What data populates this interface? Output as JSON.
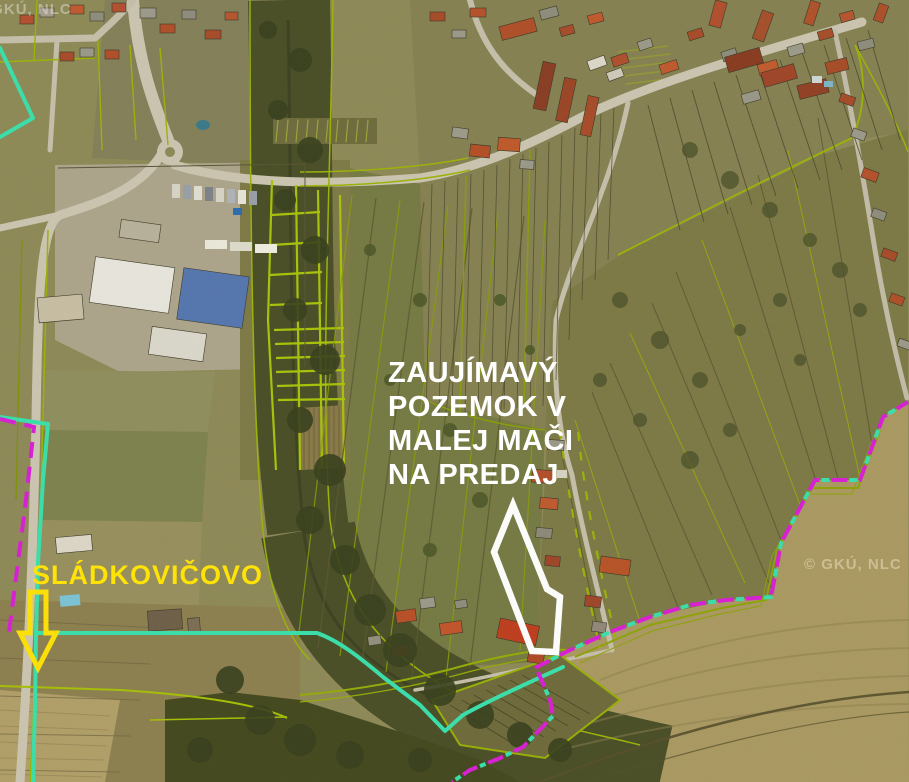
{
  "map": {
    "type": "aerial-cadastral-screenshot",
    "attribution": "© GKÚ, NLC",
    "annotations": {
      "headline": {
        "lines": [
          "ZAUJÍMAVÝ",
          "POZEMOK V",
          "MALEJ MAČI",
          "NA PREDAJ"
        ],
        "color": "#ffffff"
      },
      "town": {
        "label": "SLÁDKOVIČOVO",
        "color": "#ffe206"
      },
      "arrow": {
        "meaning": "direction to Sládkovičovo",
        "color": "#ffe206"
      },
      "subject_parcel": {
        "outline_color": "#ffffff"
      }
    },
    "legend_colors": {
      "cadastral_parcel_line": "#a7c008",
      "municipal_boundary_line": "#3ae0ac",
      "cadastral_district_boundary": "#d91fd6",
      "road": "#ccc6b2"
    }
  }
}
